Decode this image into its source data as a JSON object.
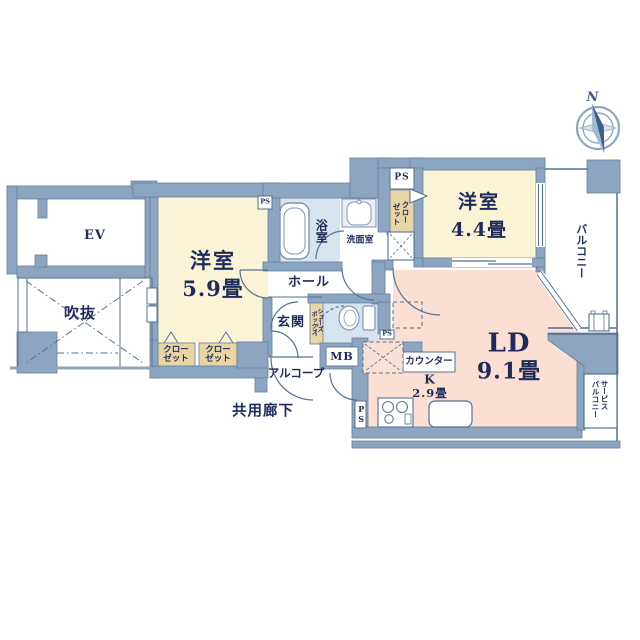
{
  "palette": {
    "wall": "#8CA6C2",
    "wall_edge": "#64809D",
    "line": "#557192",
    "text": "#1F2B5B",
    "room_cream": "#FBF3D6",
    "room_pink": "#FADFD2",
    "room_tan": "#E8D5A4",
    "room_lightblue": "#D8E3F0",
    "white": "#FFFFFF"
  },
  "compass": {
    "north": "N"
  },
  "labels": {
    "ev": "EV",
    "void": "吹抜",
    "western_5_9": {
      "name": "洋室",
      "size": "5.9畳"
    },
    "western_4_4": {
      "name": "洋室",
      "size": "4.4畳"
    },
    "living_dining": {
      "name": "LD",
      "size": "9.1畳"
    },
    "kitchen": {
      "name": "K",
      "size": "2.9畳"
    },
    "bath": "浴室",
    "washroom": "洗面室",
    "hall": "ホール",
    "entrance": "玄関",
    "alcove": "アルコープ",
    "shared_corridor": "共用廊下",
    "balcony": "バルコニー",
    "service_balcony": {
      "line1": "サービス",
      "line2": "バルコニー"
    },
    "counter": "カウンター",
    "meter_box": "MB",
    "pipe_space": "PS",
    "closet": {
      "line1": "クロー",
      "line2": "ゼット"
    },
    "shoe_box": {
      "line1": "シューズ",
      "line2": "ボックス"
    }
  }
}
